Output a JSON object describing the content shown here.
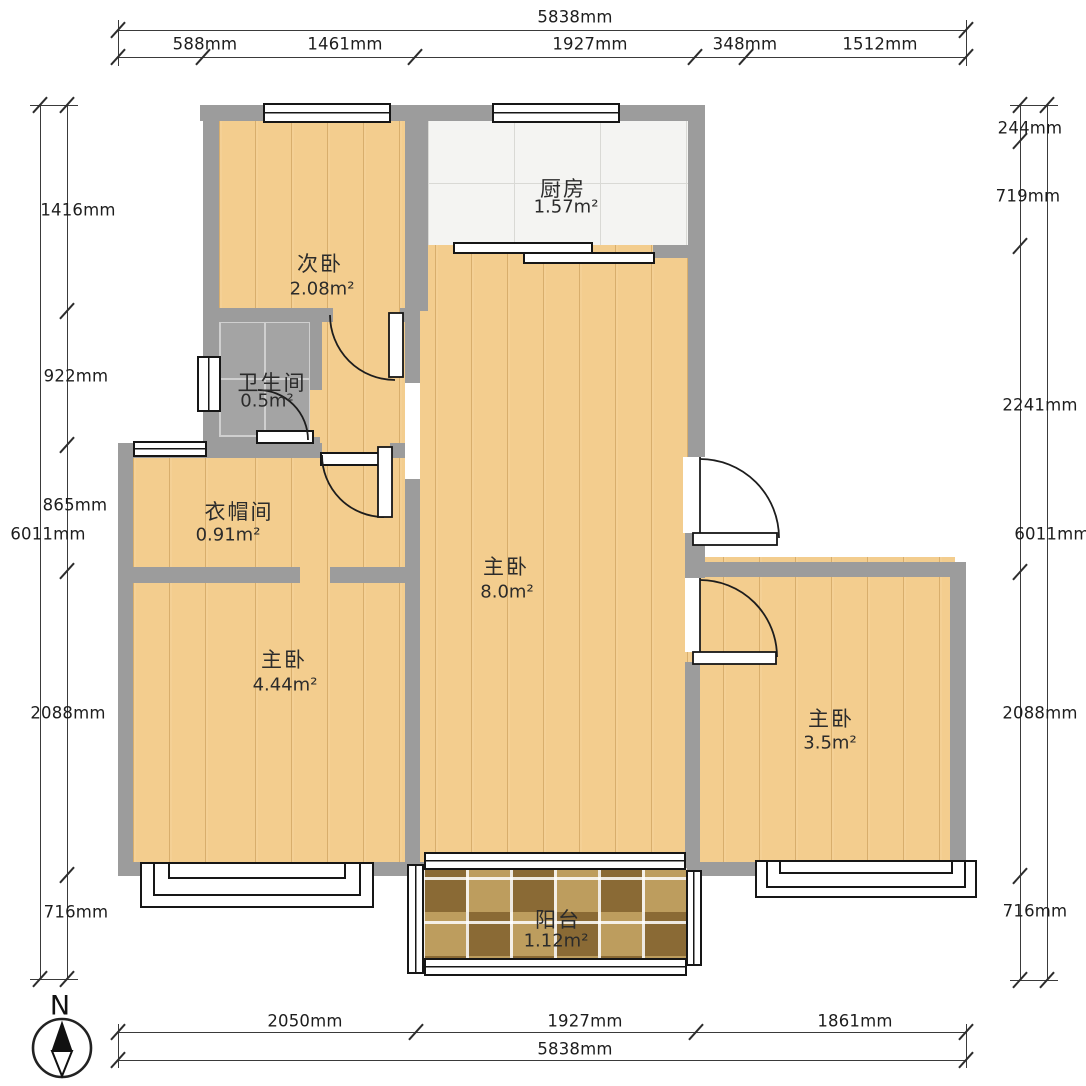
{
  "plan": {
    "title": "apartment-floor-plan",
    "compass": {
      "label": "N"
    },
    "rooms": {
      "secondary_bedroom": {
        "name": "次卧",
        "area": "2.08m²"
      },
      "kitchen": {
        "name": "厨房",
        "area": "1.57m²"
      },
      "bathroom": {
        "name": "卫生间",
        "area": "0.5m²"
      },
      "cloakroom": {
        "name": "衣帽间",
        "area": "0.91m²"
      },
      "master_center": {
        "name": "主卧",
        "area": "8.0m²"
      },
      "master_left": {
        "name": "主卧",
        "area": "4.44m²"
      },
      "master_right": {
        "name": "主卧",
        "area": "3.5m²"
      },
      "balcony": {
        "name": "阳台",
        "area": "1.12m²"
      }
    },
    "dimensions": {
      "top": {
        "total": "5838mm",
        "segments": [
          "588mm",
          "1461mm",
          "1927mm",
          "348mm",
          "1512mm"
        ]
      },
      "bottom": {
        "total": "5838mm",
        "segments": [
          "2050mm",
          "1927mm",
          "1861mm"
        ]
      },
      "left": {
        "total": "6011mm",
        "segments": [
          "1416mm",
          "922mm",
          "865mm",
          "2088mm",
          "716mm"
        ]
      },
      "right": {
        "total": "6011mm",
        "segments": [
          "244mm",
          "719mm",
          "2241mm",
          "2088mm",
          "716mm"
        ]
      }
    },
    "colors": {
      "wall": "#9c9c9c",
      "wood_floor": "#f3cd8e",
      "kitchen_tile": "#f4f4f2",
      "bath_tile": "#a4a4a4",
      "balcony_tile": "#a68648"
    }
  }
}
